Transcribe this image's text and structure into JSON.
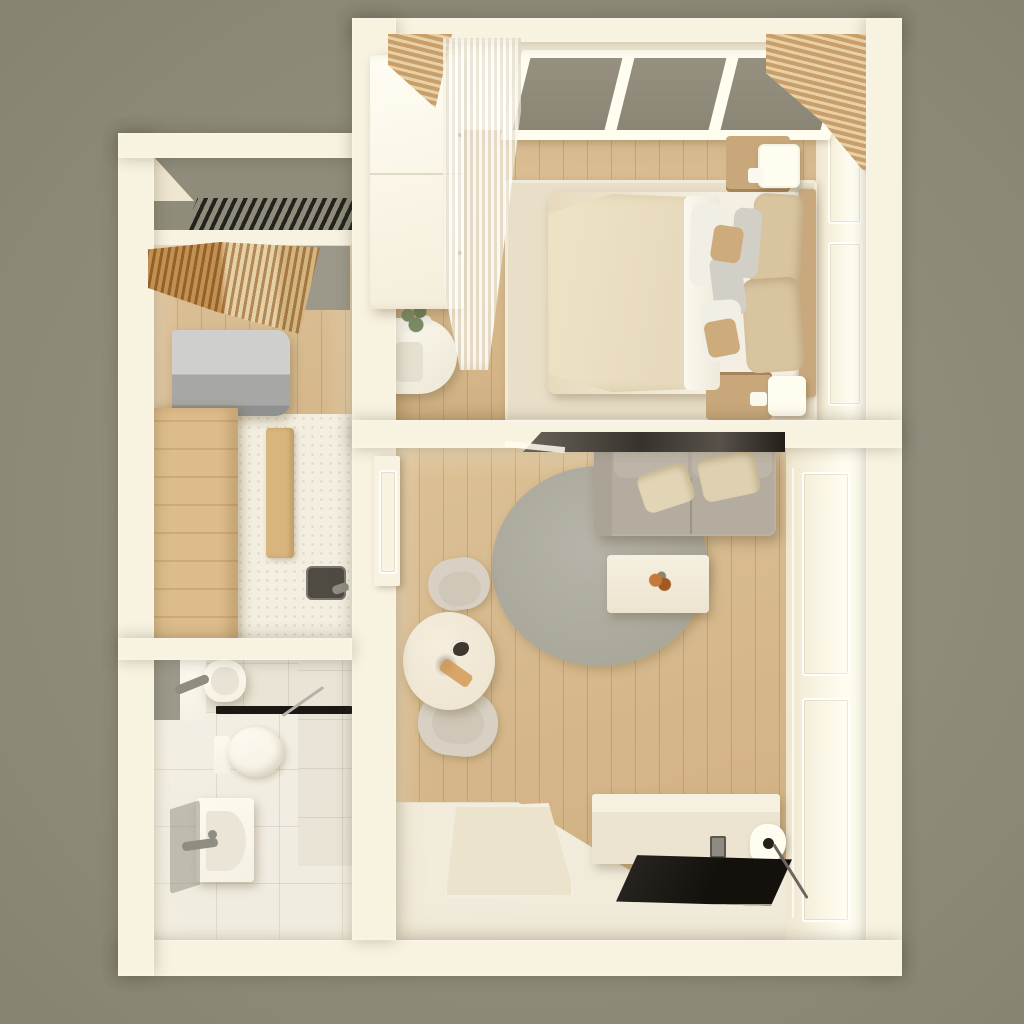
{
  "meta": {
    "kind": "3d-floor-plan-render",
    "view": "top-down",
    "style": "warm neutral / scandinavian",
    "layout": "one-bedroom apartment"
  },
  "palette": {
    "bg": "#8f8c7b",
    "bgEdge": "#868371",
    "wall": "#f8f2e1",
    "wallBright": "#fffdf0",
    "wallShade": "#efe6cf",
    "woodA": "#dcc096",
    "woodB": "#cfae80",
    "woodLine": "rgba(146,104,55,.28)",
    "rugBeige": "#e9dfc8",
    "mattress": "#f4efe2",
    "duvet": "#e7dabc",
    "pillowBeige": "#d8c5a0",
    "pillowWhite": "#f1eee5",
    "pillowGrey": "#d2cfc6",
    "cushTan": "#cdab7c",
    "headboard": "#c9a87e",
    "nightstand": "#c8a77b",
    "glass": "#8a8575",
    "slat": "#c89f6b",
    "slatLight": "#e8d1a6",
    "sofa": "#b4ac9f",
    "sofaLight": "#bdb5a7",
    "sofaCushion": "#e2d5b6",
    "rugGrey": "#aaa79b",
    "rugGreyLight": "#b6b3a8",
    "tableWood": "#eee5d2",
    "chair": "#d8d1c3",
    "chairInner": "#cfc7b8",
    "console": "#ece4d0",
    "consoleTop": "#f6f0e0",
    "tv": "#14110d",
    "steel": "#cfd0ce",
    "steelDark": "#a7a8a6",
    "cabinetWood": "#d9b57e",
    "counter": "#f3eee0",
    "sinkDark": "#4f4b42",
    "metal": "#8f8c82",
    "tile": "#e9e4d6",
    "tileFloor": "#efebdf",
    "grout": "rgba(120,110,90,.16)",
    "fixture": "#f4f0e3",
    "black": "#1b1814",
    "panelGrey": "#9c998b",
    "plant": "#7b8a66",
    "flower": "#f2f0e8",
    "accent": "#c5793a",
    "accent2": "#a05a22",
    "mat": "#ece3cc",
    "tileArea": "#f0ead9",
    "shadowDark": "#57514a"
  },
  "rooms": [
    {
      "id": "bedroom",
      "name": "Bedroom",
      "furniture": [
        "window with grey blinds",
        "sheer curtain",
        "wood-slat curtains",
        "white wardrobe",
        "armchair with plant",
        "double bed with beige duvet and pillows",
        "beige area rug",
        "nightstand with cube lamp (top)",
        "nightstand with cube lamp (bottom)",
        "panelled wall"
      ]
    },
    {
      "id": "entry-hall",
      "name": "Entry hall",
      "furniture": [
        "louvre vent grille",
        "coat rack with hanging clothes",
        "mirror panel"
      ]
    },
    {
      "id": "kitchen",
      "name": "Kitchenette",
      "furniture": [
        "refrigerator",
        "tall oak cabinet",
        "base oak cabinet",
        "speckled countertop",
        "dark sink with faucet"
      ]
    },
    {
      "id": "bathroom",
      "name": "Bathroom",
      "furniture": [
        "washbasin with faucet",
        "mirror",
        "shelf unit",
        "black shower screen",
        "shower rod",
        "toilet",
        "shower tray",
        "glass panel",
        "grab bar"
      ]
    },
    {
      "id": "living-room",
      "name": "Living room",
      "furniture": [
        "grey sofa with two beige cushions",
        "round grey rug",
        "white coffee table with decor",
        "round dining table with decor",
        "two dining chairs",
        "media console",
        "flat-screen TV",
        "antenna wire",
        "door mat",
        "open door leaf",
        "dark wall panel",
        "panelled closet wall"
      ]
    }
  ]
}
